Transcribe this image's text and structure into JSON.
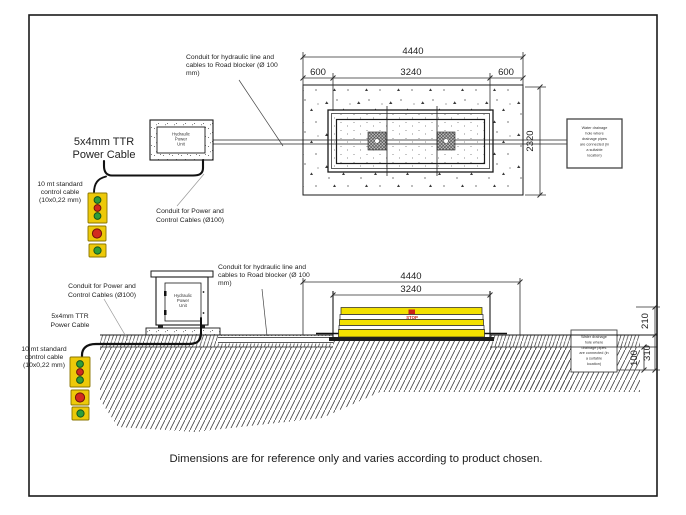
{
  "page": {
    "footer_note": "Dimensions are for reference only and varies according to product chosen."
  },
  "labels": {
    "conduit_hydraulic": [
      "Conduit for hydraulic line and",
      "cables to Road blocker (Ø 100",
      "mm)"
    ],
    "power_cable": [
      "5x4mm TTR",
      "Power Cable"
    ],
    "control_cable": [
      "10 mt standard",
      "control cable",
      "(10x0,22 mm)"
    ],
    "conduit_power": [
      "Conduit for Power and",
      "Control Cables (Ø100)"
    ],
    "hpu": [
      "Hydraulic",
      "Power",
      "Unit"
    ],
    "drainage_note": [
      "Water drainage",
      "hole where",
      "drainage pipes",
      "are connected (in",
      "a suitable",
      "location)"
    ],
    "stop": "STOP"
  },
  "plan_view": {
    "dim_total": "4440",
    "dim_left": "600",
    "dim_center": "3240",
    "dim_right": "600",
    "dim_depth": "2320"
  },
  "elevation_view": {
    "dim_total": "4440",
    "dim_inner": "3240",
    "dim_height_above": "210",
    "dim_layer": "100",
    "dim_depth": "310"
  },
  "colors": {
    "pendant_yellow": "#edc909",
    "button_green": "#2e9e3a",
    "button_red": "#d22b1e",
    "blocker_yellow": "#f2e000",
    "stop_red": "#c92418"
  }
}
